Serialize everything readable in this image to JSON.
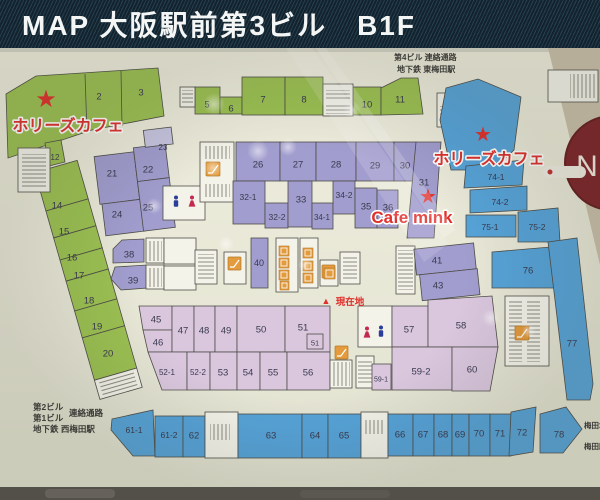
{
  "header": {
    "title": "MAP 大阪駅前第3ビル　B1F"
  },
  "map": {
    "units": {
      "2": "2",
      "3": "3",
      "5": "5",
      "6": "6",
      "7": "7",
      "8": "8",
      "10": "10",
      "11": "11",
      "12": "12",
      "14": "14",
      "15": "15",
      "16": "16",
      "17": "17",
      "18": "18",
      "19": "19",
      "20": "20",
      "21": "21",
      "22": "22",
      "23": "23",
      "24": "24",
      "25": "25",
      "26": "26",
      "27": "27",
      "28": "28",
      "29": "29",
      "30": "30",
      "31": "31",
      "32-1": "32-1",
      "32-2": "32-2",
      "33": "33",
      "34-1": "34-1",
      "34-2": "34-2",
      "35": "35",
      "36": "36",
      "38": "38",
      "39": "39",
      "40": "40",
      "41": "41",
      "43": "43",
      "45": "45",
      "46": "46",
      "47": "47",
      "48": "48",
      "49": "49",
      "50": "50",
      "51": "51",
      "51s": "51",
      "52-1": "52-1",
      "52-2": "52-2",
      "53": "53",
      "54": "54",
      "55": "55",
      "56": "56",
      "57": "57",
      "58": "58",
      "59-1": "59-1",
      "59-2": "59-2",
      "60": "60",
      "61-1": "61-1",
      "61-2": "61-2",
      "62": "62",
      "63": "63",
      "64": "64",
      "65": "65",
      "66": "66",
      "67": "67",
      "68": "68",
      "69": "69",
      "70": "70",
      "71": "71",
      "72": "72",
      "74-1": "74-1",
      "74-2": "74-2",
      "75-1": "75-1",
      "75-2": "75-2",
      "76": "76",
      "77": "77",
      "78": "78"
    }
  },
  "annotations": {
    "passage_ne1": "第4ビル 連絡通路",
    "passage_ne2": "地下鉄 東梅田駅",
    "passage_sw1": "第2ビル",
    "passage_sw2": "第1ビル",
    "passage_sw3": "連絡通路",
    "passage_sw4": "地下鉄 西梅田駅",
    "umeda1": "梅田地",
    "umeda2": "梅田駅",
    "you_are_here": "現在地",
    "hollys1": "ホリーズカフェ",
    "hollys2": "ホリーズカフェ",
    "cafe_mink": "Cafe mink",
    "n_sign": "N"
  },
  "icons": {
    "star": "★",
    "here_marker": "▲"
  },
  "colors": {
    "green": "#9cc153",
    "purple": "#a19dce",
    "purpleLight": "#c7c4e0",
    "pink": "#dac7de",
    "blue": "#57a4d9",
    "white": "#f4f3ea",
    "orange": "#e39b3d",
    "red": "#e0302c",
    "headerBg": "#14222d",
    "boardBg": "#e9e8da"
  }
}
